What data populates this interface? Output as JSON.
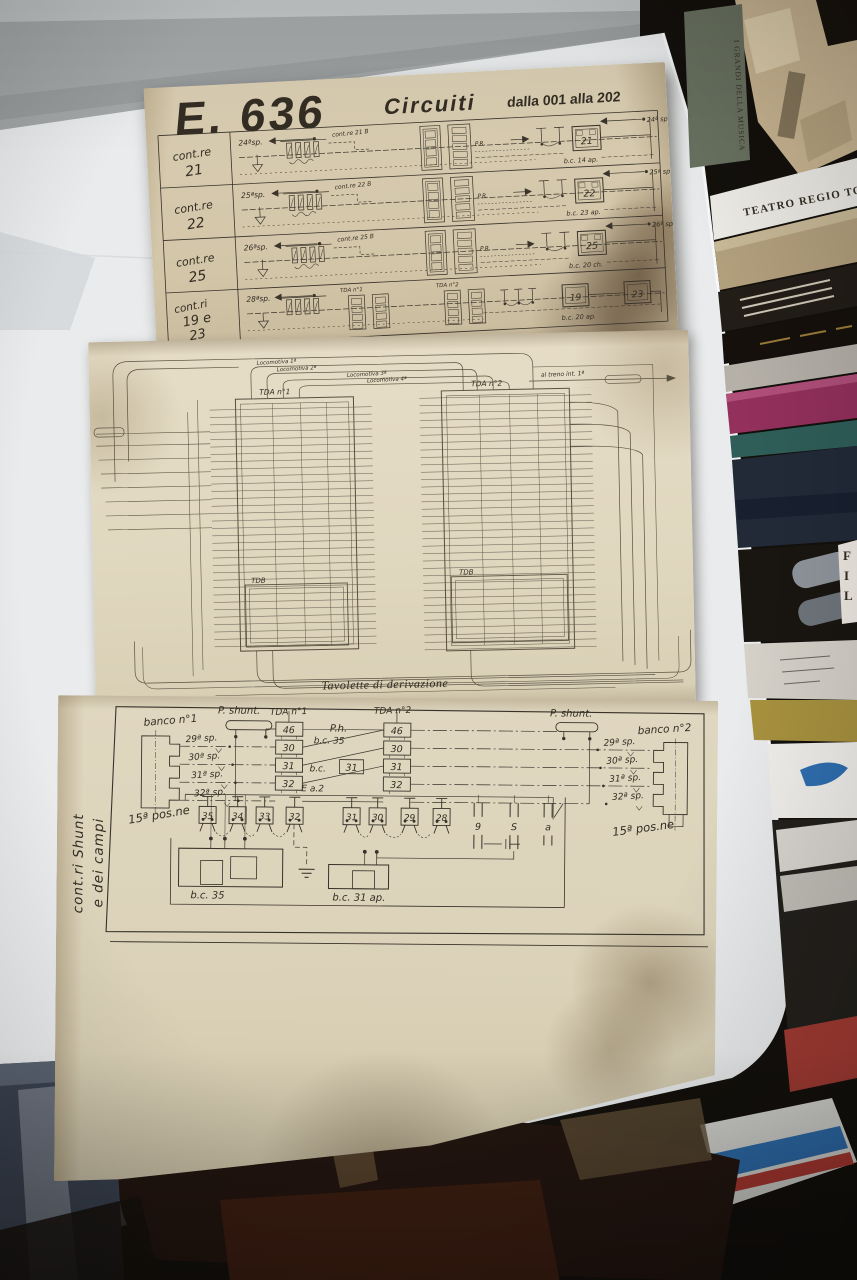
{
  "photo": {
    "book_spine_green": "I GRANDI DELLA MUSICA",
    "book_spine_white": "TEATRO REGIO TO"
  },
  "top": {
    "title": "E. 636",
    "subtitle": "Circuiti",
    "range": "dalla 001 alla 202",
    "rows": [
      {
        "label1": "cont.re",
        "label2": "21",
        "sp_left": "24ªsp.",
        "sp_right": "24ª sp.",
        "script": "cont.re 21 B",
        "pr": "P.R.",
        "box": "21",
        "bc": "b.c. 14 ap."
      },
      {
        "label1": "cont.re",
        "label2": "22",
        "sp_left": "25ªsp.",
        "sp_right": "25ª sp.",
        "script": "cont.re 22 B",
        "pr": "P.R.",
        "box": "22",
        "bc": "b.c. 23 ap."
      },
      {
        "label1": "cont.re",
        "label2": "25",
        "sp_left": "26ªsp.",
        "sp_right": "26ª sp.",
        "script": "cont.re 25 B",
        "pr": "P.R.",
        "box": "25",
        "bc": "b.c. 20 ch."
      },
      {
        "label1": "cont.ri",
        "label2": "19 e",
        "label3": "23",
        "sp_left": "28ªsp.",
        "sp_right": "28ª sp.",
        "script": "cont.ri 19-23",
        "box_a": "19",
        "box_b": "23",
        "bc": "b.c. 20 ap.",
        "tda1": "TDA n°1",
        "tda2": "TDA n°2"
      }
    ]
  },
  "middle": {
    "caption": "Tavolette di derivazione",
    "tda1": "TDA n°1",
    "tda2": "TDA n°2",
    "tdb1": "TDB",
    "tdb2": "TDB",
    "arc_labels": [
      "Locomotiva 1ª",
      "Locomotiva 2ª",
      "Locomotiva 3ª",
      "Locomotiva 4ª"
    ],
    "right_label": "al treno int. 1ª"
  },
  "bottom": {
    "side1": "cont.ri Shunt",
    "side2": "e dei campi",
    "banco1": "banco n°1",
    "banco2": "banco n°2",
    "pshunt_left": "P. shunt.",
    "pshunt_right": "P. shunt.",
    "tda1": "TDA n°1",
    "tda2": "TDA n°2",
    "ph": "P.h.",
    "bc35_wire": "b.c. 35",
    "bc31_wire": "b.c.",
    "bc31_boxed": "31",
    "ea2": "E a.2",
    "sp_left": [
      "29ª sp.",
      "30ª sp.",
      "31ª sp.",
      "32ª sp."
    ],
    "sp_right": [
      "29ª sp.",
      "30ª sp.",
      "31ª sp.",
      "32ª sp."
    ],
    "tda1_cells": [
      "46",
      "30",
      "31",
      "32"
    ],
    "tda2_cells": [
      "46",
      "30",
      "31",
      "32"
    ],
    "pos_left": "15ª pos.ne",
    "pos_right": "15ª pos.ne",
    "boxes_left": [
      "35",
      "34",
      "33",
      "32"
    ],
    "boxes_right": [
      "31",
      "30",
      "29",
      "28"
    ],
    "switches": [
      "9",
      "S",
      "a"
    ],
    "bc35_caption": "b.c. 35",
    "bc31_caption": "b.c. 31 ap."
  }
}
